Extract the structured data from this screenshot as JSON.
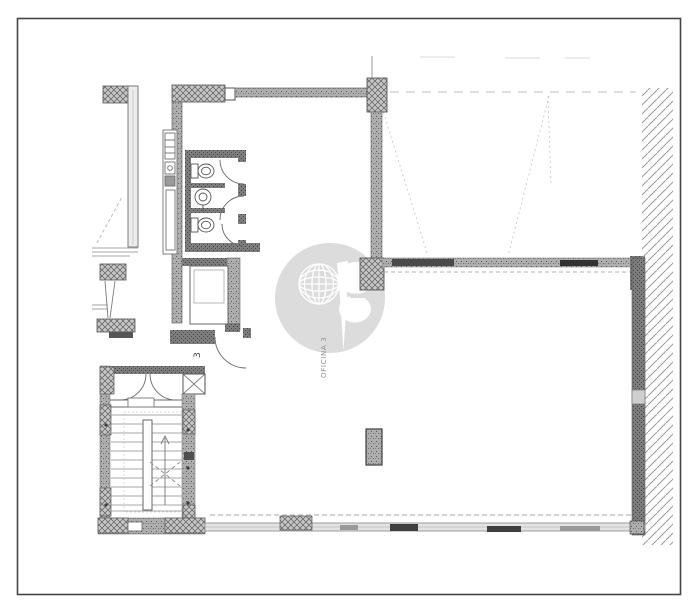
{
  "labels": {
    "room": "OFICINA 3",
    "door_number": "3"
  },
  "colors": {
    "paper": "#ffffff",
    "ink": "#4a4a4a",
    "wall_gray": "#adadad",
    "dark_wall_gray": "#7d7d7d",
    "hatch_gray": "#9b9b9b",
    "watermark_gray": "#dcdcdc"
  },
  "icons": {
    "watermark": "globe-f-watermark-logo",
    "stair_arrow": "stairs-up-arrow"
  }
}
